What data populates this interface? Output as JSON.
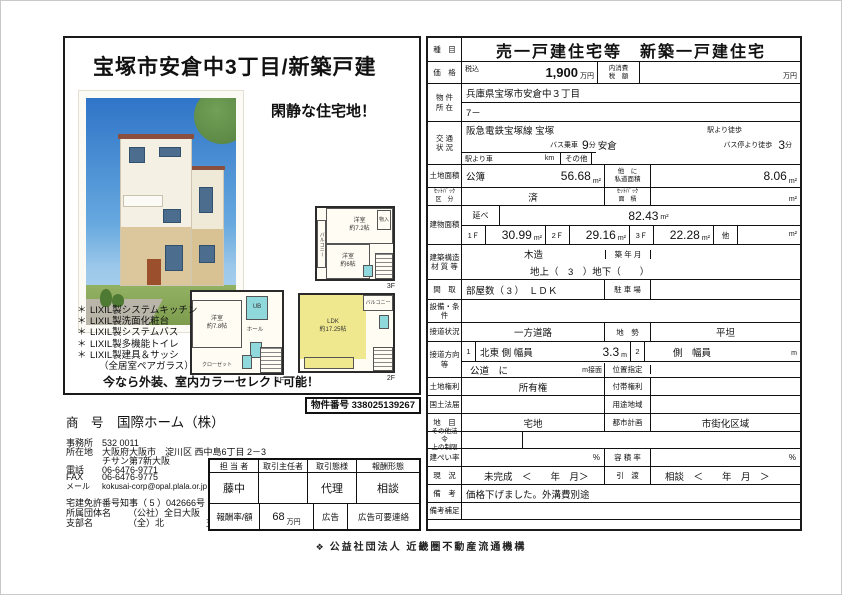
{
  "flyer": {
    "title": "宝塚市安倉中3丁目/新築戸建",
    "catchphrase": "閑静な住宅地！",
    "bullet": "＊",
    "features": [
      "LIXIL製システムキッチン",
      "LIXIL製洗面化粧台",
      "LIXIL製システムバス",
      "LIXIL製多機能トイレ",
      "LIXIL製建具＆サッシ",
      "（全居室ペアガラス）"
    ],
    "promo": "今なら外装、室内カラーセレクト可能！",
    "plans": {
      "f3": {
        "room_top": "洋室\n約7.2帖",
        "room_bottom": "洋室\n約6帖",
        "balcony": "バルコニー",
        "closet": "物入",
        "floor": "3F"
      },
      "f1": {
        "room": "洋室\n約7.8帖",
        "hall": "ホール",
        "ub": "UB",
        "closet": "クローゼット",
        "floor": "1F"
      },
      "f2": {
        "ldk": "LDK\n約17.25帖",
        "balcony": "バルコニー",
        "floor": "2F"
      }
    }
  },
  "company": {
    "property_no_label": "物件番号",
    "property_no": "338025139267",
    "name_label": "商　号",
    "name": "国際ホーム（株）",
    "office_label": "事務所",
    "office": "532 0011",
    "address_label": "所在地",
    "address1": "大阪府大阪市　淀川区 西中島6丁目 2－3",
    "address2": "チサン第7新大阪",
    "tel_label": "電話",
    "tel": "06-6476-9771",
    "fax_label": "FAX",
    "fax": "06-6476-9775",
    "mail_label": "メール",
    "mail": "kokusai-corp@opal.plala.or.jp",
    "license_label": "宅建免許番号",
    "license": "知事（ 5 ）042666号",
    "org_label": "所属団体名",
    "org": "（公社）全日大阪",
    "branch_label": "支部名",
    "branch": "（全）北",
    "branch_suffix": "支部"
  },
  "agent": {
    "headers": [
      "担 当 者",
      "取引主任者",
      "取引態様",
      "報酬形態"
    ],
    "person": "藤中",
    "chief": "",
    "mode": "代理",
    "fee_type": "相談",
    "fee_label": "報酬率/額",
    "fee_value": "68",
    "fee_unit": "万円",
    "ad_label": "広告",
    "ad_value": "広告可要連絡"
  },
  "listing": {
    "type": {
      "label": "種　目",
      "value": "売一戸建住宅等　新築一戸建住宅"
    },
    "price": {
      "label": "価　格",
      "tax": "税込",
      "value": "1,900",
      "unit": "万円",
      "inner_tax": "内消費\n税　額",
      "inner_unit": "万円"
    },
    "location": {
      "label": "物 件\n所 在",
      "line1": "兵庫県宝塚市安倉中３丁目",
      "line2": "7－"
    },
    "transport": {
      "label": "交 通\n状 況",
      "line": "阪急電鉄宝塚線 宝塚",
      "walk": "駅より徒歩",
      "bus": "バス乗車",
      "bus_min": "9",
      "min": "分",
      "stop": "安倉",
      "busstop": "バス停より徒歩",
      "busstop_min": "3",
      "car": "駅より車",
      "km": "km",
      "other": "その他"
    },
    "land": {
      "label": "土地面積",
      "kind": "公簿",
      "value": "56.68",
      "unit": "m²",
      "private_label": "他　に\n私道面積",
      "private_value": "8.06",
      "private_unit": "m²"
    },
    "setback": {
      "label": "ｾｯﾄﾊﾞｯｸ\n区　分",
      "value": "済",
      "area_label": "ｾｯﾄﾊﾞｯｸ\n面　積",
      "unit": "m²"
    },
    "building": {
      "label": "建物面積",
      "total_label": "延べ",
      "total": "82.43",
      "unit": "m²",
      "f1": "1Ｆ",
      "f1v": "30.99",
      "f2": "2Ｆ",
      "f2v": "29.16",
      "f3": "3Ｆ",
      "f3v": "22.28",
      "other": "他"
    },
    "structure": {
      "label": "建築構造\n材 質 等",
      "value": "木造",
      "built": "築 年 月",
      "floors": "地上（　3　）地下（　　）"
    },
    "layout": {
      "label": "間　取",
      "value": "部屋数（ 3 ）　ＬＤＫ",
      "parking": "駐 車 場"
    },
    "equipment": {
      "label": "設備・条件"
    },
    "road": {
      "label": "接道状況",
      "value": "一方道路",
      "terrain_label": "地　勢",
      "terrain": "平坦"
    },
    "road_dir": {
      "label": "接道方向\n等",
      "n1": "1",
      "dir1": "北東 側 幅員",
      "w1": "3.3",
      "m": "m",
      "n2": "2",
      "dir2": "側　幅員",
      "m2": "m",
      "type": "公道　に",
      "front": "m接面",
      "pos": "位置指定"
    },
    "rights": {
      "label": "土地権利",
      "value": "所有権",
      "attached": "付帯権利"
    },
    "kokudo": {
      "label": "国土法届",
      "zone": "用途地域"
    },
    "chimoku": {
      "label": "地　目",
      "value": "宅地",
      "city_label": "都市計画",
      "city": "市街化区域"
    },
    "other_law": {
      "label": "その他法令\n上の制限"
    },
    "coverage": {
      "label": "建ぺい率",
      "pct": "%",
      "far_label": "容 積 率",
      "far_pct": "%"
    },
    "status": {
      "label": "現　況",
      "value": "未完成　＜　　年　月＞",
      "handover_label": "引　渡",
      "handover": "相談　＜　　年　月　＞"
    },
    "remarks": {
      "label": "備　考",
      "value": "価格下げました。外溝費別途"
    },
    "remarks2": {
      "label": "備考補足"
    }
  },
  "footer": {
    "logo": "❖",
    "org": "公益社団法人 近畿圏不動産流通機構"
  }
}
